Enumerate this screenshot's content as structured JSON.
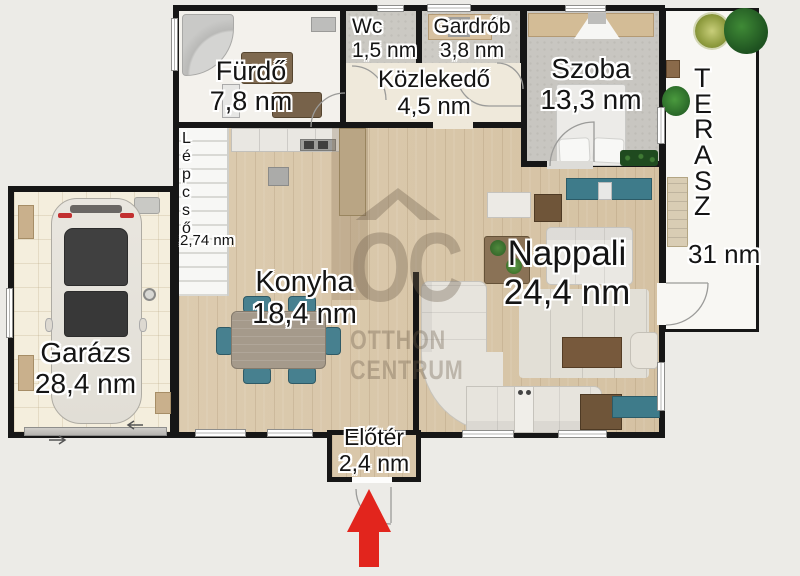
{
  "rooms": {
    "bathroom": {
      "name": "Fürdő",
      "area": "7,8 nm"
    },
    "wc": {
      "name": "Wc",
      "area": "1,5 nm"
    },
    "wardrobe": {
      "name": "Gardrób",
      "area": "3,8 nm"
    },
    "hallway": {
      "name": "Közlekedő",
      "area": "4,5 nm"
    },
    "bedroom": {
      "name": "Szoba",
      "area": "13,3 nm"
    },
    "stairs": {
      "name": "Lépcső",
      "area": "2,74 nm"
    },
    "kitchen": {
      "name": "Konyha",
      "area": "18,4 nm"
    },
    "living_room": {
      "name": "Nappali",
      "area": "24,4 nm"
    },
    "garage": {
      "name": "Garázs",
      "area": "28,4 nm"
    },
    "entry": {
      "name": "Előtér",
      "area": "2,4 nm"
    },
    "terrace": {
      "name": "TERASZ",
      "area": "31 nm"
    }
  },
  "watermark": {
    "logo": "OC",
    "line1": "OTTHON",
    "line2": "CENTRUM"
  },
  "colors": {
    "wall": "#161616",
    "background": "#ECEBE7",
    "wood_floor": "#D9C7AA",
    "accent_teal": "#3E7B8A",
    "entrance_arrow_red": "#E2251D"
  }
}
